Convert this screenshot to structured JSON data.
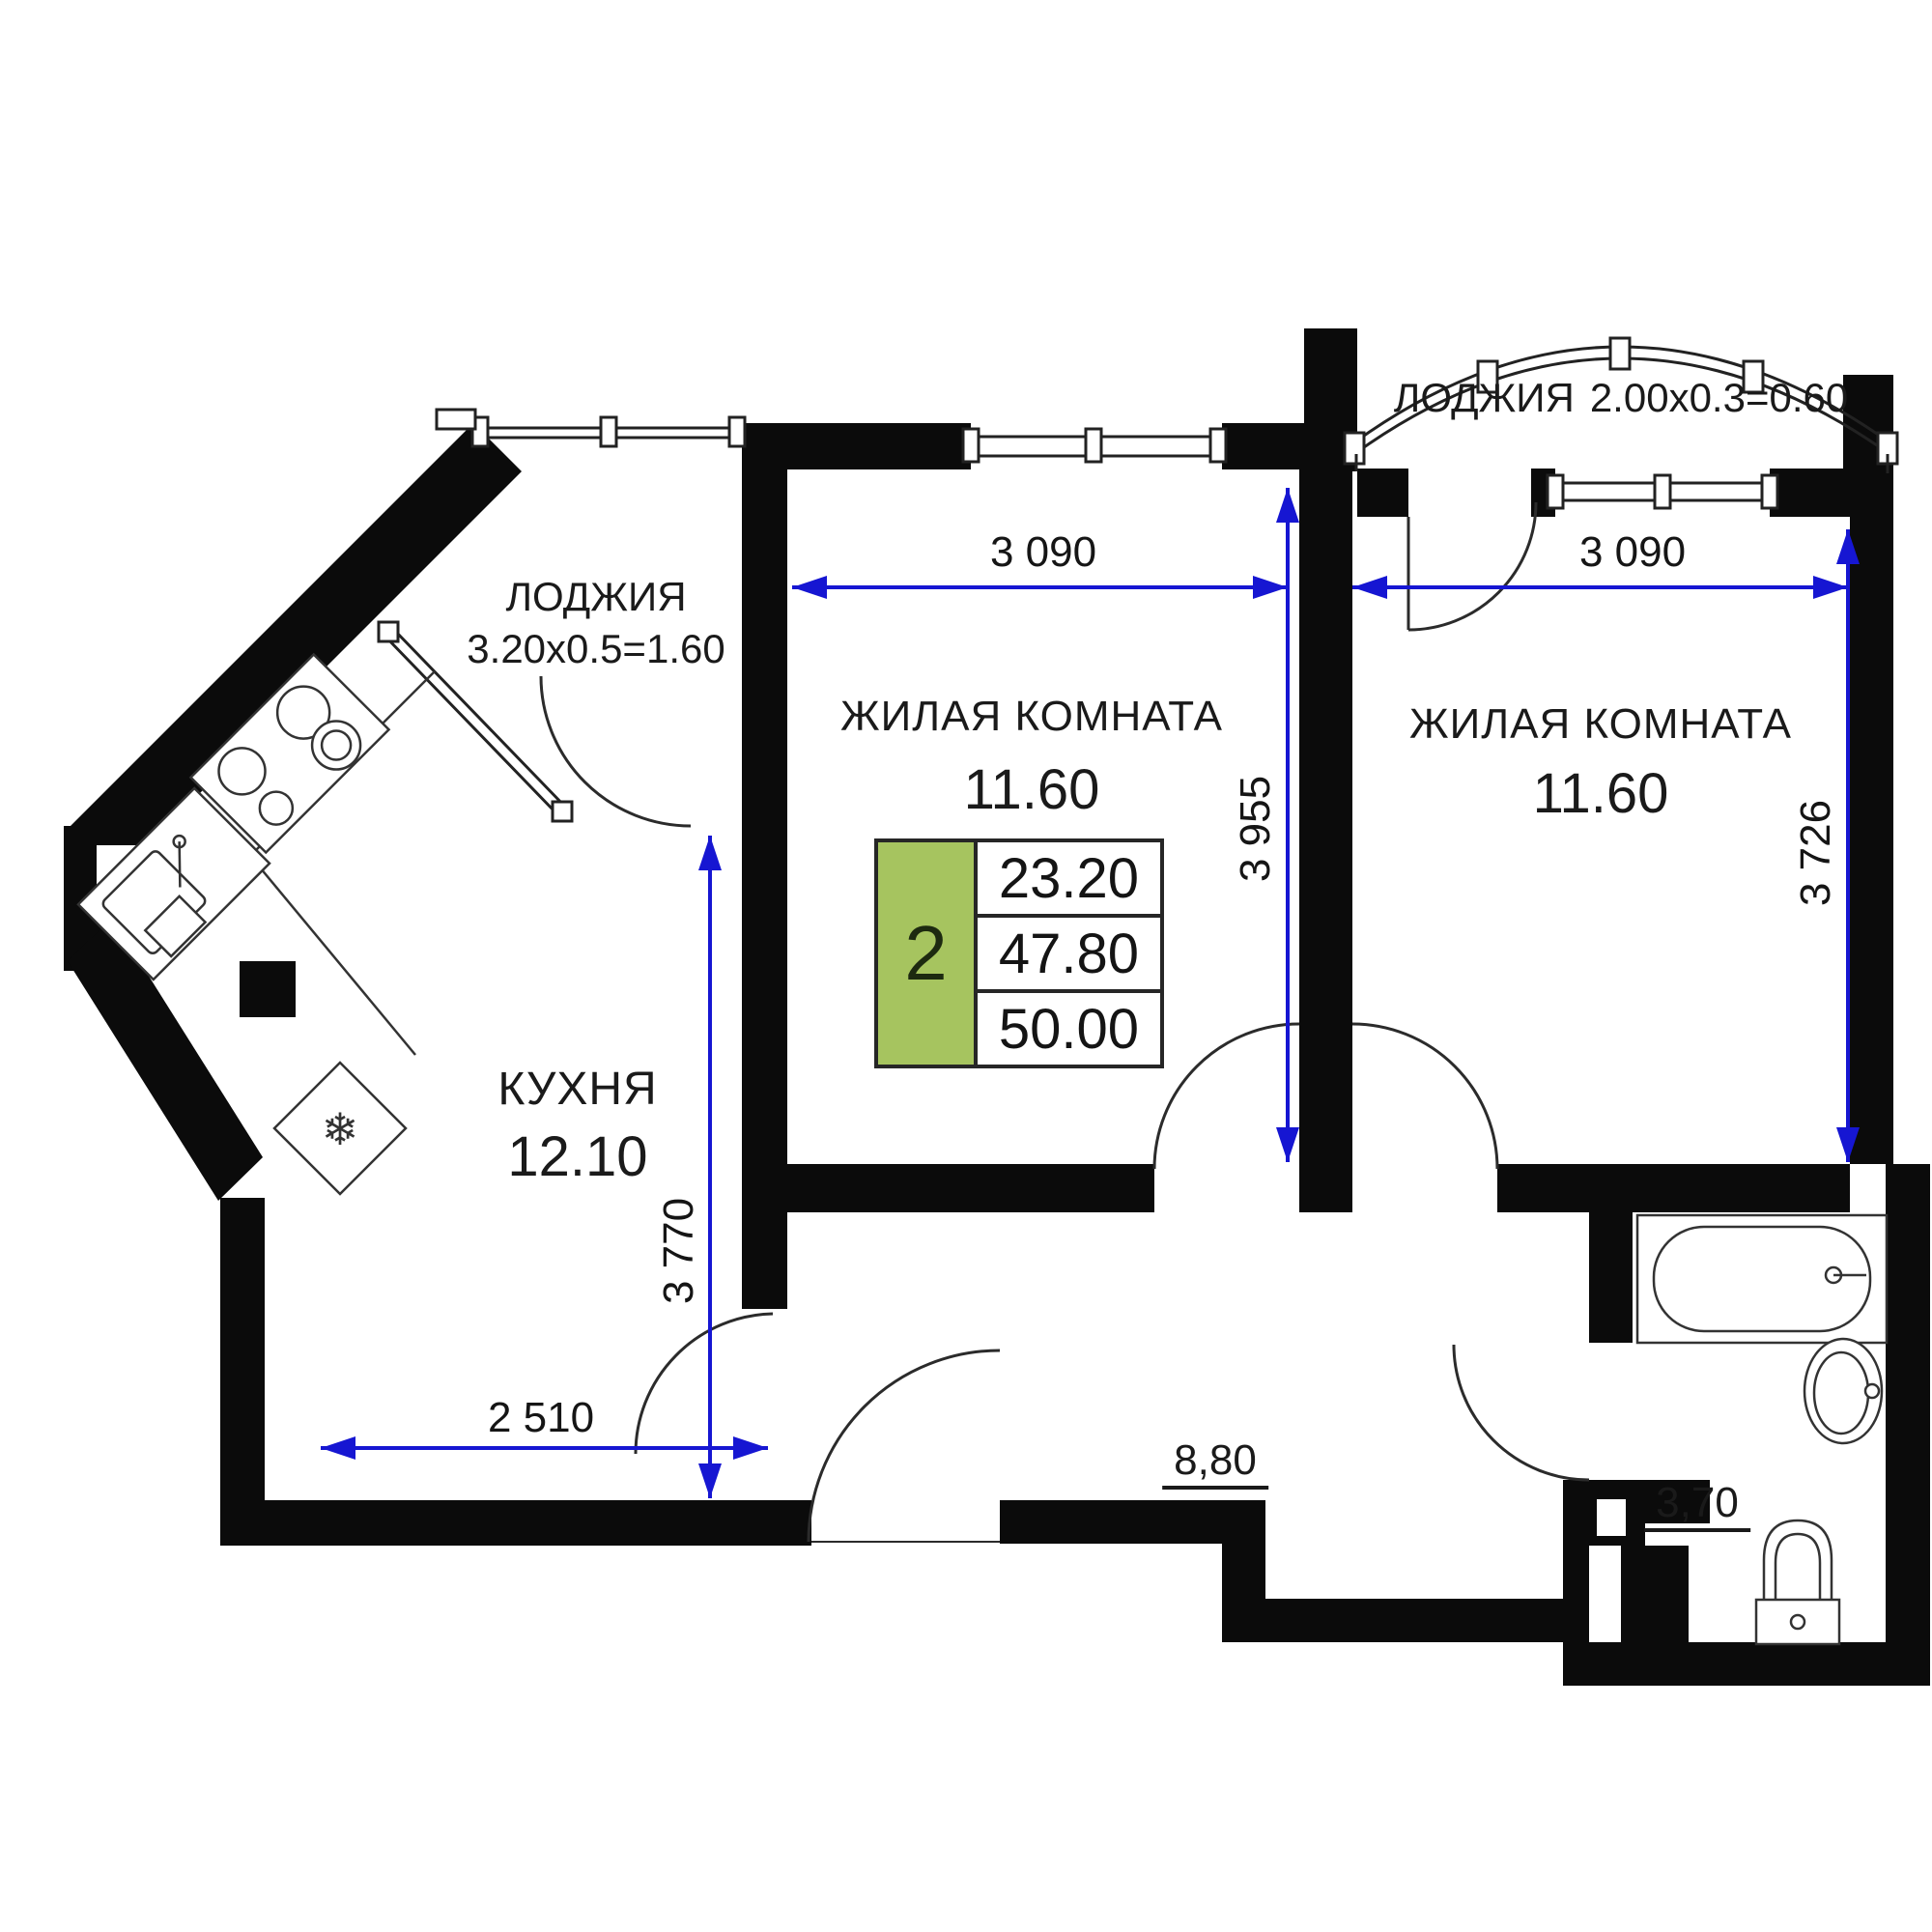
{
  "plan": {
    "wall_color": "#0B0B0B",
    "dimension_color": "#1616D2",
    "accent_green": "#A6C45F"
  },
  "rooms": {
    "loggia_left": {
      "name": "ЛОДЖИЯ",
      "size": "3.20x0.5=1.60"
    },
    "loggia_right": {
      "name": "ЛОДЖИЯ",
      "size": "2.00x0.3=0.60"
    },
    "living_room_1": {
      "name": "ЖИЛАЯ КОМНАТА",
      "area": "11.60"
    },
    "living_room_2": {
      "name": "ЖИЛАЯ КОМНАТА",
      "area": "11.60"
    },
    "kitchen": {
      "name": "КУХНЯ",
      "area": "12.10"
    },
    "hallway": {
      "area": "8,80"
    },
    "bathroom": {
      "area": "3,70"
    }
  },
  "info_table": {
    "rooms_count": "2",
    "living_area": "23.20",
    "area_without_loggia": "47.80",
    "total_area": "50.00"
  },
  "dimensions": {
    "living1_width": "3 090",
    "living2_width": "3 090",
    "living1_depth": "3 955",
    "living2_depth": "3 726",
    "kitchen_depth": "3 770",
    "kitchen_width": "2 510"
  },
  "icons": {
    "fridge_snowflake": "❄"
  }
}
